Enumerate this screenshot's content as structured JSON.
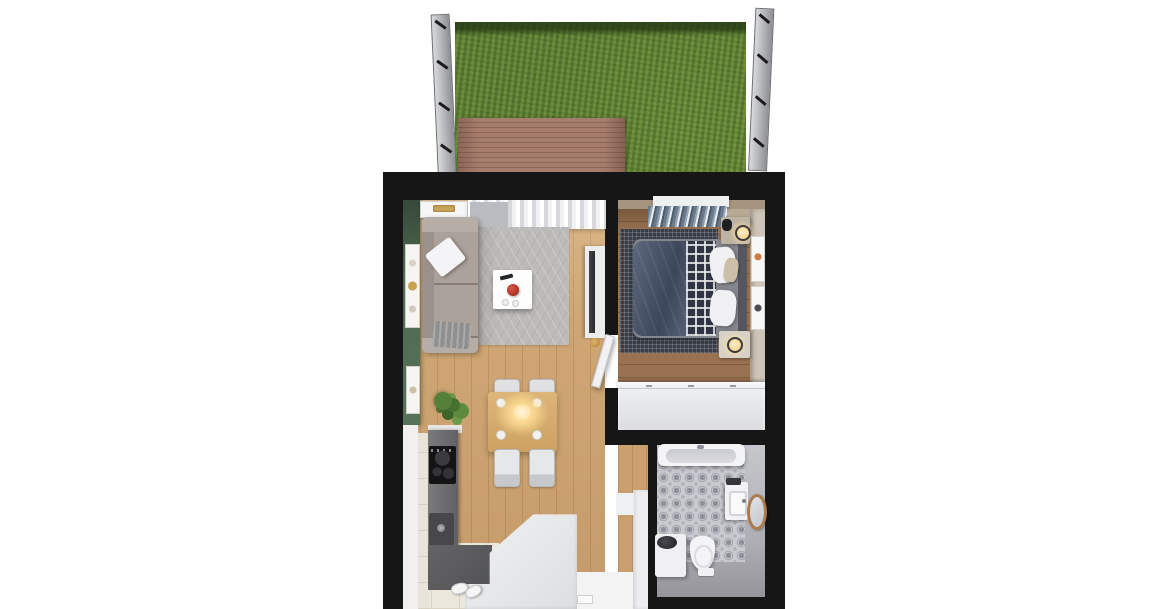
{
  "scene": {
    "kind": "3d-floorplan-top-view-render",
    "text_content": "none-visible",
    "palette": {
      "background": "#ffffff",
      "walls": "#161617",
      "grass": "#63853a",
      "deck_wood": "#9b7261",
      "fence": "#c9cacd",
      "living_wood_floor": "#cfa674",
      "bedroom_wood_floor": "#9a7251",
      "green_accent_wall": "#4e6b51",
      "sofa_gray": "#aba29b",
      "living_rug": "#bdbbba",
      "coffee_table": "#fdfdfd",
      "red_bowl": "#b5372a",
      "curtains_white": "#f1f1f3",
      "blinds_blue_gray": "#6a7a8c",
      "duvet_navy": "#49566e",
      "plaid_blanket": "#2f3542",
      "bedroom_rug_dark": "#383d48",
      "wardrobe_white": "#e9eaec",
      "bathroom_tile": "#c9cacf",
      "bathroom_floor": "#adadb3",
      "mirror_wood": "#aa7a4b",
      "kitchen_counter_dark": "#6b6b6d",
      "cooktop_black": "#141415",
      "entry_tile_cream": "#ece7dc",
      "dining_table_wood": "#d3a96b",
      "lamp_glow_warm": "#ffdf9e"
    },
    "areas": {
      "garden": [
        "fence-left",
        "fence-right",
        "grass-lawn",
        "wood-deck"
      ],
      "living-room": [
        "green-accent-wall",
        "wall-art",
        "ceiling-lamp",
        "window-curtains",
        "sofa",
        "throw-pillow",
        "blanket",
        "area-rug",
        "coffee-table",
        "red-bowl",
        "remote",
        "tv-console",
        "tv",
        "deer-figurine"
      ],
      "dining-kitchen": [
        "dining-table",
        "chairs",
        "pendant-light",
        "plates",
        "potted-plant",
        "kitchen-counter",
        "cooktop",
        "kitchen-sink",
        "entry-closet",
        "shoes",
        "entry-tiles"
      ],
      "bedroom": [
        "window-blinds",
        "valance",
        "bedroom-rug",
        "double-bed",
        "navy-duvet",
        "plaid-blanket",
        "pillows",
        "nightstands",
        "table-lamps",
        "wall-frames",
        "wardrobe",
        "door"
      ],
      "bathroom": [
        "bathtub",
        "patterned-tile-floor",
        "vanity-sink",
        "round-wood-mirror",
        "washing-machine",
        "toilet",
        "bath-mat"
      ]
    }
  }
}
